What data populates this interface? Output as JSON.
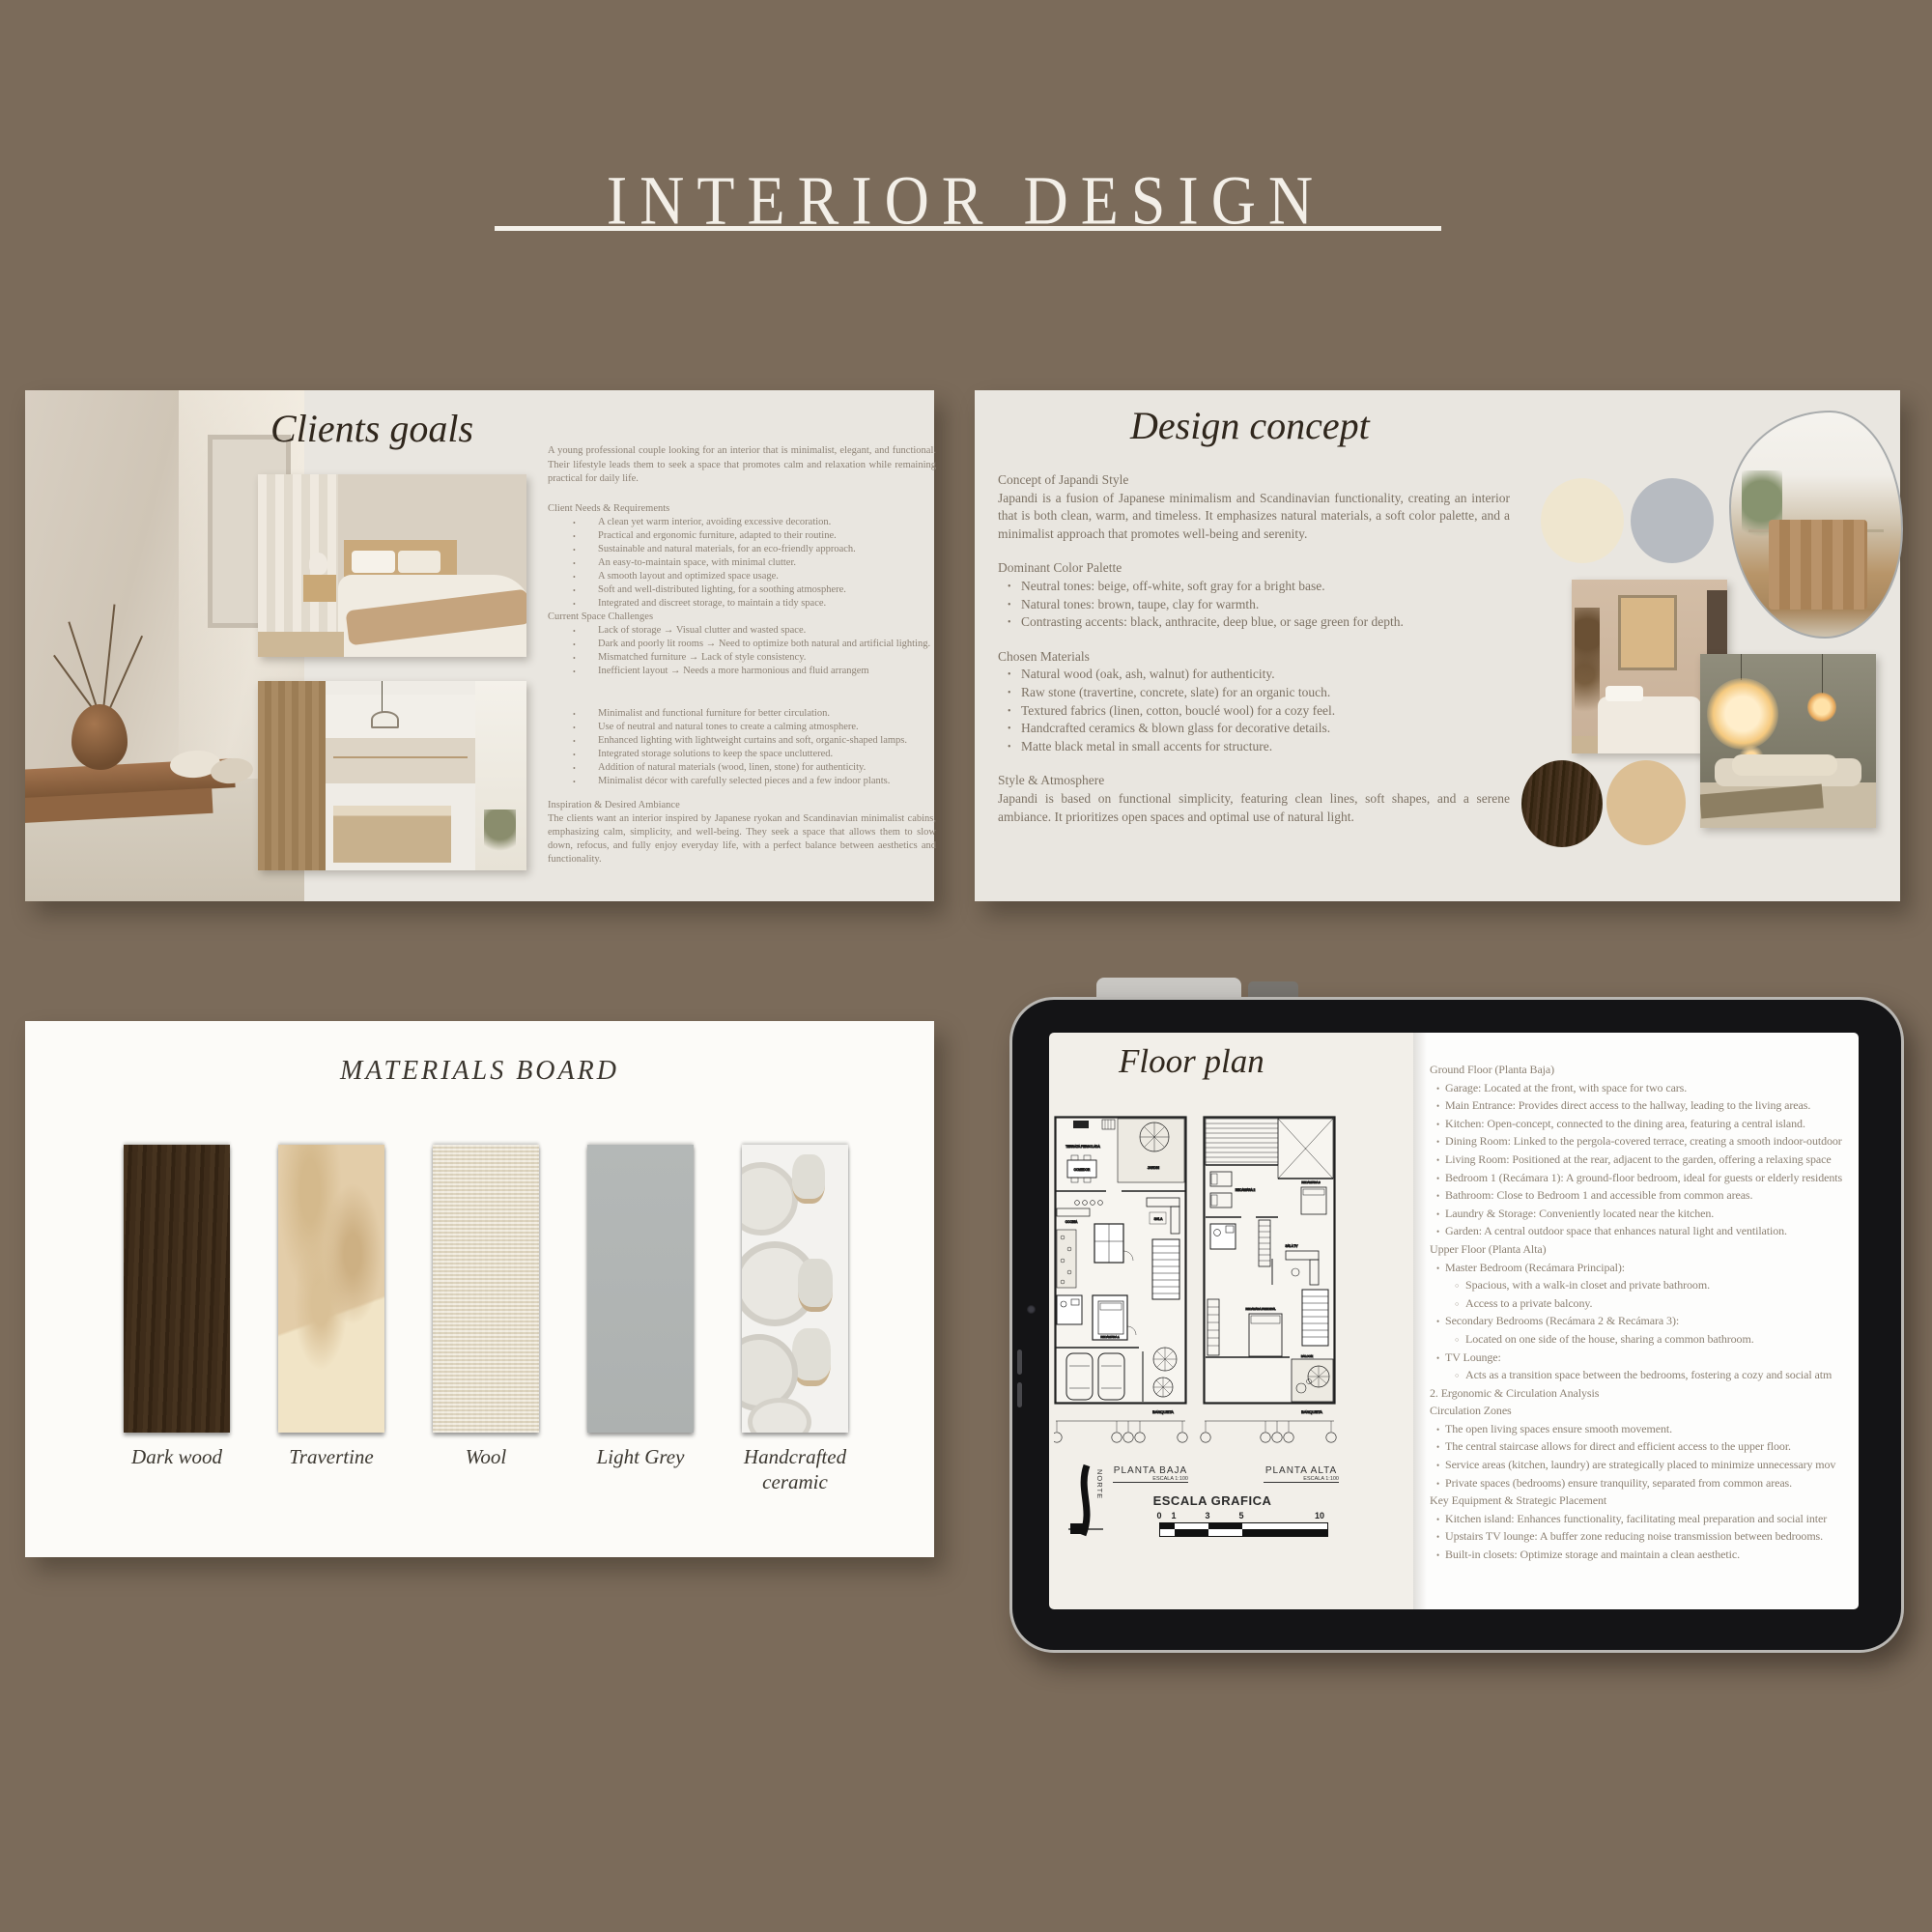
{
  "page": {
    "title": "INTERIOR DESIGN",
    "background_color": "#7b6b5a"
  },
  "clients_goals": {
    "heading": "Clients goals",
    "intro": "A young professional couple looking for an interior that is minimalist, elegant, and functional. Their lifestyle leads them to seek a space that promotes calm and relaxation while remaining practical for daily life.",
    "block_a": [
      {
        "l": "h",
        "t": "Client Needs & Requirements"
      },
      {
        "l": "b",
        "t": "A clean yet warm interior, avoiding excessive decoration."
      },
      {
        "l": "b",
        "t": "Practical and ergonomic furniture, adapted to their routine."
      },
      {
        "l": "b",
        "t": "Sustainable and natural materials, for an eco-friendly approach."
      },
      {
        "l": "b",
        "t": "An easy-to-maintain space, with minimal clutter."
      },
      {
        "l": "b",
        "t": "A smooth layout and optimized space usage."
      },
      {
        "l": "b",
        "t": "Soft and well-distributed lighting, for a soothing atmosphere."
      },
      {
        "l": "b",
        "t": "Integrated and discreet storage, to maintain a tidy space."
      },
      {
        "l": "h",
        "t": "Current Space Challenges"
      },
      {
        "l": "b",
        "t": "Lack of storage → Visual clutter and wasted space."
      },
      {
        "l": "b",
        "t": "Dark and poorly lit rooms → Need to optimize both natural and artificial lighting."
      },
      {
        "l": "b",
        "t": "Mismatched furniture → Lack of style consistency."
      },
      {
        "l": "b",
        "t": "Inefficient layout → Needs a more harmonious and fluid arrangem"
      }
    ],
    "block_b": [
      {
        "l": "b",
        "t": "Minimalist and functional furniture for better circulation."
      },
      {
        "l": "b",
        "t": "Use of neutral and natural tones to create a calming atmosphere."
      },
      {
        "l": "b",
        "t": "Enhanced lighting with lightweight curtains and soft, organic-shaped lamps."
      },
      {
        "l": "b",
        "t": "Integrated storage solutions to keep the space uncluttered."
      },
      {
        "l": "b",
        "t": "Addition of natural materials (wood, linen, stone) for authenticity."
      },
      {
        "l": "b",
        "t": "Minimalist décor with carefully selected pieces and a few indoor plants."
      }
    ],
    "inspiration_heading": "Inspiration & Desired Ambiance",
    "inspiration_text": "The clients want an interior inspired by Japanese ryokan and Scandinavian minimalist cabins, emphasizing calm, simplicity, and well-being. They seek a space that allows them to slow down, refocus, and fully enjoy everyday life, with a perfect balance between aesthetics and functionality."
  },
  "design_concept": {
    "heading": "Design concept",
    "sections": [
      {
        "l": "h",
        "t": "Concept of Japandi Style"
      },
      {
        "l": "p",
        "t": "Japandi is a fusion of Japanese minimalism and Scandinavian functionality, creating an interior that is both clean, warm, and timeless. It emphasizes natural materials, a soft color palette, and a minimalist approach that promotes well-being and serenity."
      },
      {
        "l": "h",
        "t": "Dominant Color Palette"
      },
      {
        "l": "b",
        "t": "Neutral tones: beige, off-white, soft gray for a bright base."
      },
      {
        "l": "b",
        "t": "Natural tones: brown, taupe, clay for warmth."
      },
      {
        "l": "b",
        "t": "Contrasting accents: black, anthracite, deep blue, or sage green for depth."
      },
      {
        "l": "h",
        "t": "Chosen Materials"
      },
      {
        "l": "b",
        "t": "Natural wood (oak, ash, walnut) for authenticity."
      },
      {
        "l": "b",
        "t": "Raw stone (travertine, concrete, slate) for an organic touch."
      },
      {
        "l": "b",
        "t": "Textured fabrics (linen, cotton, bouclé wool) for a cozy feel."
      },
      {
        "l": "b",
        "t": "Handcrafted ceramics & blown glass for decorative details."
      },
      {
        "l": "b",
        "t": "Matte black metal in small accents for structure."
      },
      {
        "l": "h",
        "t": "Style & Atmosphere"
      },
      {
        "l": "p",
        "t": "Japandi is based on functional simplicity, featuring clean lines, soft shapes, and a serene ambiance. It prioritizes open spaces and optimal use of natural light."
      }
    ],
    "palette": {
      "cream": "#efe6cf",
      "soft_grey": "#b7bbc1",
      "dark_wood": "#3a2a1d",
      "tan": "#dcbf94"
    }
  },
  "materials_board": {
    "heading": "MATERIALS BOARD",
    "items": [
      {
        "label": "Dark wood",
        "color": "#3b2a1c"
      },
      {
        "label": "Travertine",
        "color": "#e2cba7"
      },
      {
        "label": "Wool",
        "color": "#ece4d1"
      },
      {
        "label": "Light Grey",
        "color": "#b1b5b4"
      },
      {
        "label": "Handcrafted ceramic",
        "color": "#efeeea"
      }
    ]
  },
  "floor_plan": {
    "heading": "Floor plan",
    "drawing": {
      "plan_ground_label": "PLANTA BAJA",
      "plan_upper_label": "PLANTA ALTA",
      "scale_note": "ESCALA 1:100",
      "scale_bar_title": "ESCALA GRAFICA",
      "scale_ticks": [
        "0",
        "1",
        "3",
        "5",
        "10"
      ],
      "north_label": "NORTE",
      "sidewalk_label": "BANQUETA",
      "rooms_ground": [
        "TERRAZA PERGOLADA",
        "JARDIN",
        "COMEDOR",
        "COCINA",
        "SALA",
        "RECAMARA 1"
      ],
      "rooms_upper": [
        "RECAMARA 2",
        "RECAMARA 3",
        "SALA TV",
        "RECAMARA PRINCIPAL",
        "BALCON"
      ]
    },
    "lines": [
      {
        "l": "h",
        "t": "Ground Floor (Planta Baja)"
      },
      {
        "l": "b",
        "t": "Garage: Located at the front, with space for two cars."
      },
      {
        "l": "b",
        "t": "Main Entrance: Provides direct access to the hallway, leading to the living areas."
      },
      {
        "l": "b",
        "t": "Kitchen: Open-concept, connected to the dining area, featuring a central island."
      },
      {
        "l": "b",
        "t": "Dining Room: Linked to the pergola-covered terrace, creating a smooth indoor-outdoor"
      },
      {
        "l": "b",
        "t": "Living Room: Positioned at the rear, adjacent to the garden, offering a relaxing space"
      },
      {
        "l": "b",
        "t": "Bedroom 1 (Recámara 1): A ground-floor bedroom, ideal for guests or elderly residents"
      },
      {
        "l": "b",
        "t": "Bathroom: Close to Bedroom 1 and accessible from common areas."
      },
      {
        "l": "b",
        "t": "Laundry & Storage: Conveniently located near the kitchen."
      },
      {
        "l": "b",
        "t": "Garden: A central outdoor space that enhances natural light and ventilation."
      },
      {
        "l": "h",
        "t": "Upper Floor (Planta Alta)"
      },
      {
        "l": "b",
        "t": "Master Bedroom (Recámara Principal):"
      },
      {
        "l": "s",
        "t": "Spacious, with a walk-in closet and private bathroom."
      },
      {
        "l": "s",
        "t": "Access to a private balcony."
      },
      {
        "l": "b",
        "t": "Secondary Bedrooms (Recámara 2 & Recámara 3):"
      },
      {
        "l": "s",
        "t": "Located on one side of the house, sharing a common bathroom."
      },
      {
        "l": "b",
        "t": "TV Lounge:"
      },
      {
        "l": "s",
        "t": "Acts as a transition space between the bedrooms, fostering a cozy and social atm"
      },
      {
        "l": "h",
        "t": "2. Ergonomic & Circulation Analysis"
      },
      {
        "l": "h",
        "t": "Circulation Zones"
      },
      {
        "l": "b",
        "t": "The open living spaces ensure smooth movement."
      },
      {
        "l": "b",
        "t": "The central staircase allows for direct and efficient access to the upper floor."
      },
      {
        "l": "b",
        "t": "Service areas (kitchen, laundry) are strategically placed to minimize unnecessary mov"
      },
      {
        "l": "b",
        "t": "Private spaces (bedrooms) ensure tranquility, separated from common areas."
      },
      {
        "l": "h",
        "t": "Key Equipment & Strategic Placement"
      },
      {
        "l": "b",
        "t": "Kitchen island: Enhances functionality, facilitating meal preparation and social inter"
      },
      {
        "l": "b",
        "t": "Upstairs TV lounge: A buffer zone reducing noise transmission between bedrooms."
      },
      {
        "l": "b",
        "t": "Built-in closets: Optimize storage and maintain a clean aesthetic."
      }
    ]
  }
}
